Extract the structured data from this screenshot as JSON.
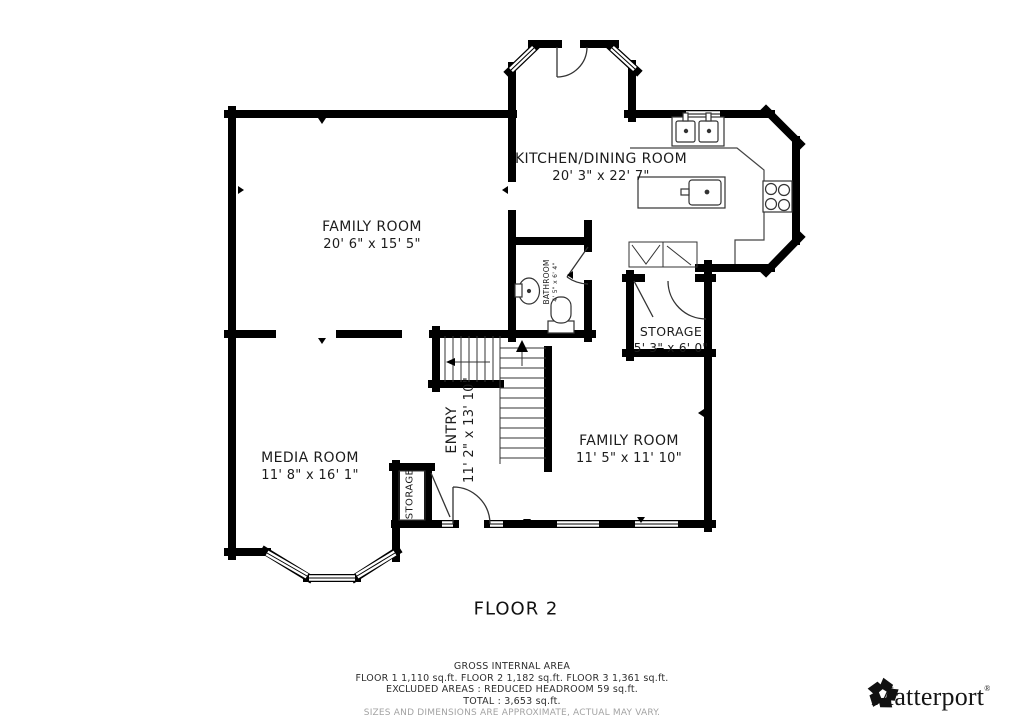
{
  "floor_title": "FLOOR 2",
  "rooms": {
    "kitchen": {
      "name": "KITCHEN/DINING ROOM",
      "dims": "20' 3\" x 22' 7\""
    },
    "family1": {
      "name": "FAMILY ROOM",
      "dims": "20' 6\" x 15' 5\""
    },
    "bathroom": {
      "name": "BATHROOM",
      "dims": "4' 5\" x 6' 4\""
    },
    "storage1": {
      "name": "STORAGE",
      "dims": "5' 3\" x 6' 0\""
    },
    "entry": {
      "name": "ENTRY",
      "dims": "11' 2\" x 13' 10\""
    },
    "family2": {
      "name": "FAMILY ROOM",
      "dims": "11' 5\" x 11' 10\""
    },
    "media": {
      "name": "MEDIA ROOM",
      "dims": "11' 8\" x 16' 1\""
    },
    "storage2": {
      "name": "STORAGE"
    }
  },
  "footer": {
    "gross": "GROSS INTERNAL AREA",
    "floors": "FLOOR 1 1,110 sq.ft.    FLOOR 2 1,182 sq.ft.    FLOOR 3 1,361 sq.ft.",
    "excluded": "EXCLUDED AREAS :  REDUCED HEADROOM 59 sq.ft.",
    "total": "TOTAL :  3,653 sq.ft.",
    "disclaimer": "SIZES AND DIMENSIONS ARE APPROXIMATE, ACTUAL MAY VARY."
  },
  "branding": {
    "name": "Matterport",
    "reg": "®"
  },
  "colors": {
    "wall": "#000000",
    "thin_line": "#333333",
    "label": "#1c1c1c",
    "disclaimer": "#a3a3a3"
  }
}
